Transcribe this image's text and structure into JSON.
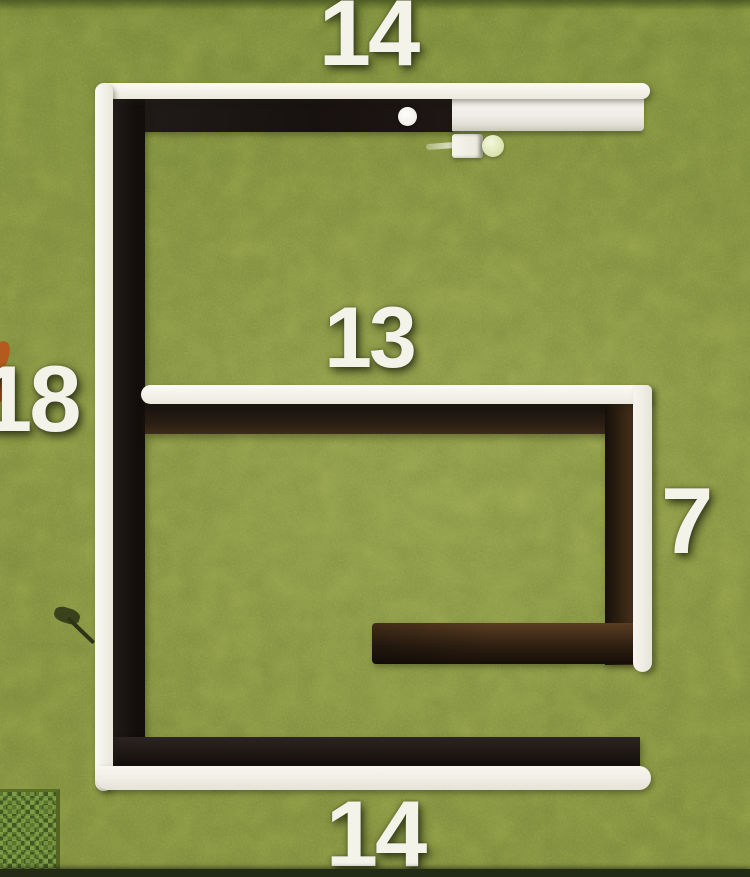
{
  "scene": {
    "description": "Top-down Minecraft-style view of an E-shaped / spiral wall build on grass, annotated with block measurements",
    "ground": "grass-field",
    "colors": {
      "grass": "#7e8d3f",
      "wall_dark": "#1d1512",
      "wall_brown": "#4a3320",
      "outline_white": "#f2f0e8",
      "label_text": "#f4f3ea",
      "bush_dark": "#3e5a20",
      "bush_light": "#5a772c"
    }
  },
  "measurements": {
    "top_width": "14",
    "inner_width": "13",
    "left_height": "18",
    "right_height": "7",
    "bottom_width": "14"
  },
  "entities": {
    "player": "player-character",
    "item_dot": "white-item",
    "bush": "leaf-bush",
    "twig": "fallen-stick",
    "orange_item": "orange-item"
  }
}
